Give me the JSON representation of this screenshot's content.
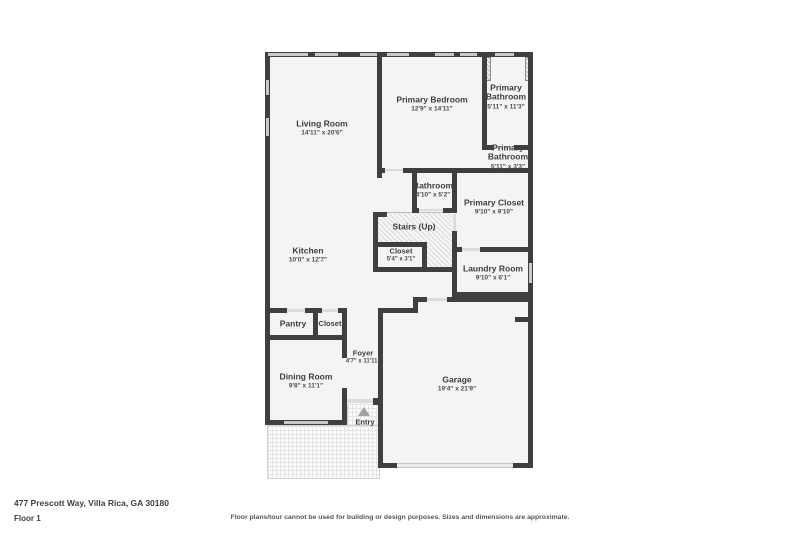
{
  "page": {
    "address": "477 Prescott Way, Villa Rica, GA 30180",
    "floor_label": "Floor 1",
    "disclaimer": "Floor plans/tour cannot be used for building or design purposes. Sizes and dimensions are approximate."
  },
  "colors": {
    "wall": "#3f3f3f",
    "room_fill": "#f4f4f4",
    "window": "#c9c9c9",
    "text": "#3d3d3d"
  },
  "rooms": [
    {
      "name": "Living Room",
      "dims": "14'11\" x 20'6\""
    },
    {
      "name": "Primary Bedroom",
      "dims": "12'9\" x 14'11\""
    },
    {
      "name": "Primary Bathroom",
      "dims": "5'11\" x 11'3\""
    },
    {
      "name": "Primary Bathroom",
      "dims": "5'11\" x 3'3\""
    },
    {
      "name": "Bathroom",
      "dims": "4'10\" x 5'2\""
    },
    {
      "name": "Primary Closet",
      "dims": "9'10\" x 9'10\""
    },
    {
      "name": "Stairs (Up)",
      "dims": ""
    },
    {
      "name": "Closet",
      "dims": "5'4\" x 3'1\""
    },
    {
      "name": "Kitchen",
      "dims": "10'0\" x 12'7\""
    },
    {
      "name": "Laundry Room",
      "dims": "9'10\" x 6'1\""
    },
    {
      "name": "Pantry",
      "dims": ""
    },
    {
      "name": "Closet",
      "dims": ""
    },
    {
      "name": "Foyer",
      "dims": "4'7\" x 11'11\""
    },
    {
      "name": "Dining Room",
      "dims": "9'8\" x 11'1\""
    },
    {
      "name": "Garage",
      "dims": "19'4\" x 21'9\""
    },
    {
      "name": "Entry",
      "dims": ""
    }
  ]
}
